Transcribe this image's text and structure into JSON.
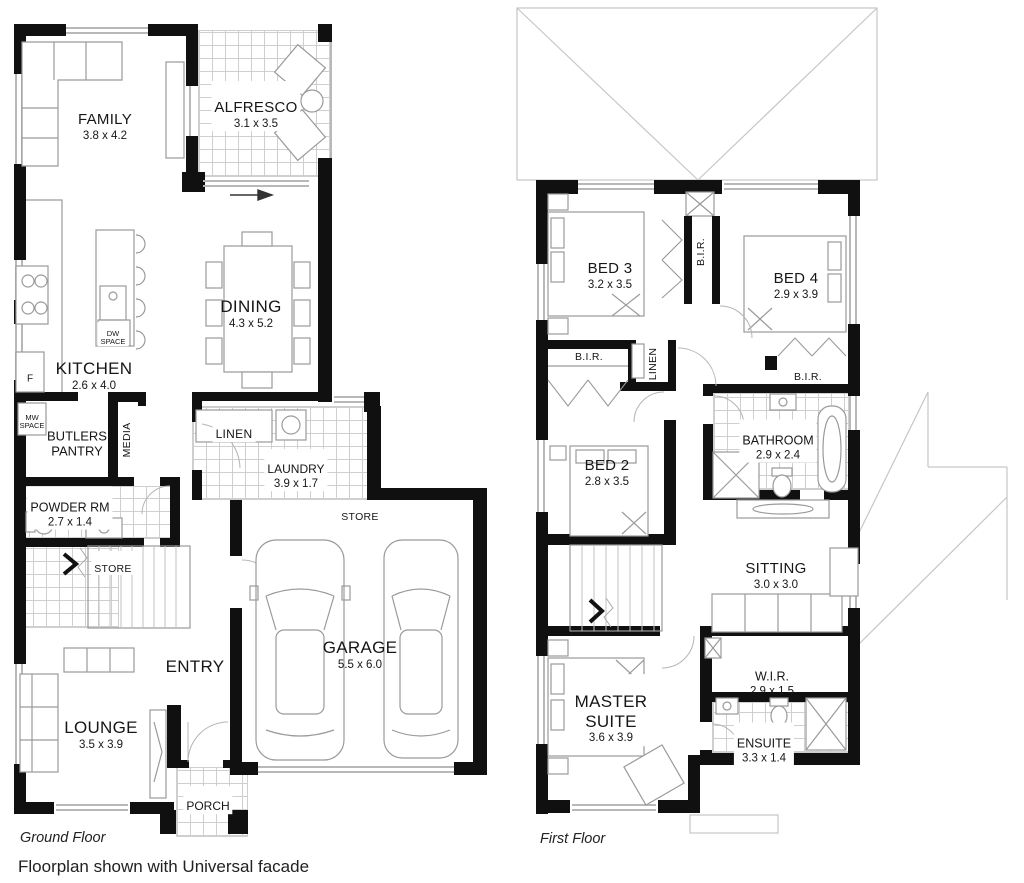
{
  "caption": "Floorplan shown with Universal facade",
  "colors": {
    "wall": "#101010",
    "fixture_line": "#9a9a9a",
    "tile_line": "#cfcfcf",
    "text": "#161616"
  },
  "ground_floor": {
    "label": "Ground Floor",
    "rooms": {
      "family": {
        "name": "FAMILY",
        "dims": "3.8 x 4.2"
      },
      "alfresco": {
        "name": "ALFRESCO",
        "dims": "3.1 x 3.5"
      },
      "dining": {
        "name": "DINING",
        "dims": "4.3 x 5.2"
      },
      "kitchen": {
        "name": "KITCHEN",
        "dims": "2.6 x 4.0"
      },
      "butlers_pantry": {
        "name": "BUTLERS\nPANTRY"
      },
      "media": {
        "name": "MEDIA"
      },
      "linen": {
        "name": "LINEN"
      },
      "laundry": {
        "name": "LAUNDRY",
        "dims": "3.9 x 1.7"
      },
      "powder_rm": {
        "name": "POWDER RM",
        "dims": "2.7 x 1.4"
      },
      "store_hall": {
        "name": "STORE"
      },
      "store_garage": {
        "name": "STORE"
      },
      "garage": {
        "name": "GARAGE",
        "dims": "5.5 x 6.0"
      },
      "entry": {
        "name": "ENTRY"
      },
      "lounge": {
        "name": "LOUNGE",
        "dims": "3.5 x 3.9"
      },
      "porch": {
        "name": "PORCH"
      },
      "fridge": {
        "name": "F"
      },
      "mw_space": {
        "name": "MW\nSPACE"
      },
      "dw_space": {
        "name": "DW\nSPACE"
      }
    }
  },
  "first_floor": {
    "label": "First Floor",
    "rooms": {
      "bed3": {
        "name": "BED 3",
        "dims": "3.2 x 3.5"
      },
      "bed4": {
        "name": "BED 4",
        "dims": "2.9 x 3.9"
      },
      "bir_hall": {
        "name": "B.I.R."
      },
      "bir_bed2": {
        "name": "B.I.R."
      },
      "linen": {
        "name": "LINEN"
      },
      "bir_bed4": {
        "name": "B.I.R."
      },
      "bathroom": {
        "name": "BATHROOM",
        "dims": "2.9 x 2.4"
      },
      "bed2": {
        "name": "BED 2",
        "dims": "2.8 x 3.5"
      },
      "sitting": {
        "name": "SITTING",
        "dims": "3.0 x 3.0"
      },
      "wir": {
        "name": "W.I.R.",
        "dims": "2.9 x 1.5"
      },
      "master_suite": {
        "name": "MASTER\nSUITE",
        "dims": "3.6 x 3.9"
      },
      "ensuite": {
        "name": "ENSUITE",
        "dims": "3.3 x 1.4"
      }
    }
  }
}
